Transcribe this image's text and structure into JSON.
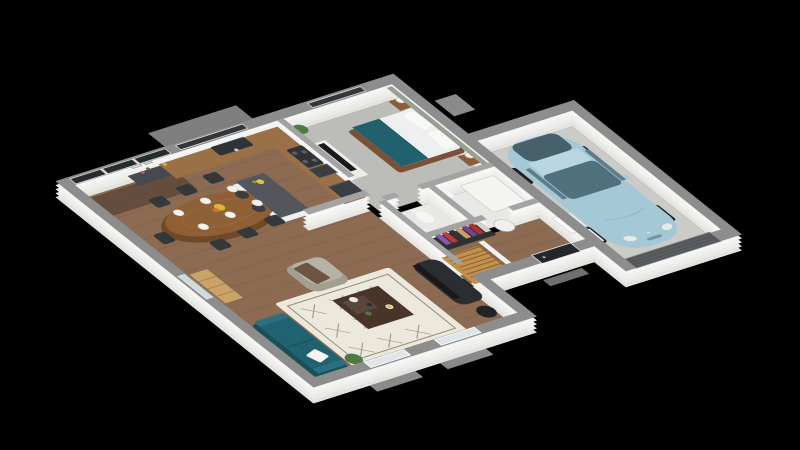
{
  "canvas": {
    "width": 800,
    "height": 450,
    "background": "#000000"
  },
  "scene": {
    "kind": "3d-floor-plan-render",
    "view": "isometric-top-down",
    "storey": "ground-floor",
    "rooms": [
      {
        "name": "dining-area",
        "floor": "wood",
        "furniture": [
          "oval-dining-table",
          "eight-dark-chairs",
          "white-place-settings",
          "yellow-flower-centerpiece",
          "dark-sideboard-with-frames"
        ]
      },
      {
        "name": "kitchen",
        "floor": "wood",
        "furniture": [
          "l-shaped-counter",
          "sink",
          "cooktop",
          "oven",
          "tall-fridge",
          "island-with-dark-top",
          "bar-stools",
          "fruit-bowl"
        ]
      },
      {
        "name": "bedroom",
        "floor": "grey-carpet",
        "accent_wall": "sage-green",
        "furniture": [
          "double-bed-teal-throw",
          "two-nightstands",
          "ball-lamps",
          "dresser-with-tv",
          "potted-plant"
        ]
      },
      {
        "name": "bathroom",
        "floor": "tile",
        "furniture": [
          "shower-tray",
          "washbasin"
        ]
      },
      {
        "name": "wc",
        "floor": "tile",
        "furniture": [
          "toilet"
        ]
      },
      {
        "name": "hallway",
        "floor": "wood",
        "furniture": [
          "open-wardrobe-with-clothes",
          "water-heater",
          "wood-staircase",
          "white-door-to-garage"
        ]
      },
      {
        "name": "living-room",
        "floor": "wood",
        "furniture": [
          "teal-sofa-white-pillow",
          "beige-armchair-brown-throw",
          "berber-rug",
          "dark-coffee-table-decor",
          "black-tv-unit",
          "black-stove",
          "oak-bookcase",
          "potted-plants"
        ]
      },
      {
        "name": "garage",
        "floor": "concrete",
        "furniture": [
          "light-blue-hatchback-car",
          "white-storage-units",
          "sectional-garage-door"
        ]
      }
    ],
    "openings": [
      "sliding-glass-bay",
      "kitchen-window",
      "bedroom-window",
      "left-wall-window",
      "two-living-room-windows",
      "black-front-door",
      "garage-door"
    ]
  },
  "colors": {
    "background": "#000000",
    "wall_top": "#8d8d8d",
    "wall_top_inner": "#a3a3a3",
    "wall_face": "#f2f2f0",
    "terrace": "#7f7f7f",
    "wood_floor": "#8d6a52",
    "wood_plank": "#74543e",
    "bedroom_carpet": "#bcbcb8",
    "bath_tile": "#e8e8e6",
    "garage_floor": "#cbcbc8",
    "rug": "#ece8dc",
    "rug_pattern": "#6f6658",
    "sofa": "#206270",
    "sofa_dark": "#174f5b",
    "armchair": "#b6b2a4",
    "throw_blanket": "#6d5443",
    "coffee_table": "#483528",
    "tv_black": "#17191b",
    "tv_stand": "#2b2e31",
    "bookcase": "#c9a368",
    "dining_table": "#8f5f36",
    "chair": "#34383b",
    "sideboard": "#46494d",
    "cabinet": "#ececea",
    "counter_wood": "#9a7047",
    "appliance": "#2f3337",
    "island_top": "#53565a",
    "island_base": "#eef0ef",
    "stool": "#3a3e41",
    "stairs": "#c2914e",
    "stairs_line": "#8a5e2e",
    "bed_frame": "#7b5036",
    "duvet": "#eef0f0",
    "bed_throw": "#21616e",
    "accent_wall": "#96a192",
    "nightstand": "#8a5c3a",
    "car_body": "#a5c8d6",
    "car_glass": "#51707e",
    "car_dark": "#46606c",
    "wheel": "#1f2226",
    "front_door": "#24272a",
    "garage_door": "#54575a",
    "slider_glass": "#262b30",
    "window_glass": "#dfe6e8",
    "window_dark": "#31363a",
    "plant": "#4c7a42",
    "water_heater": "#f0f0ee",
    "wardrobe_interior": "#2e3134",
    "clothes": [
      "#8a56b0",
      "#c13a3a",
      "#2f3236",
      "#c9a05e",
      "#7b3f8f",
      "#b03030",
      "#d8d2c8"
    ]
  }
}
